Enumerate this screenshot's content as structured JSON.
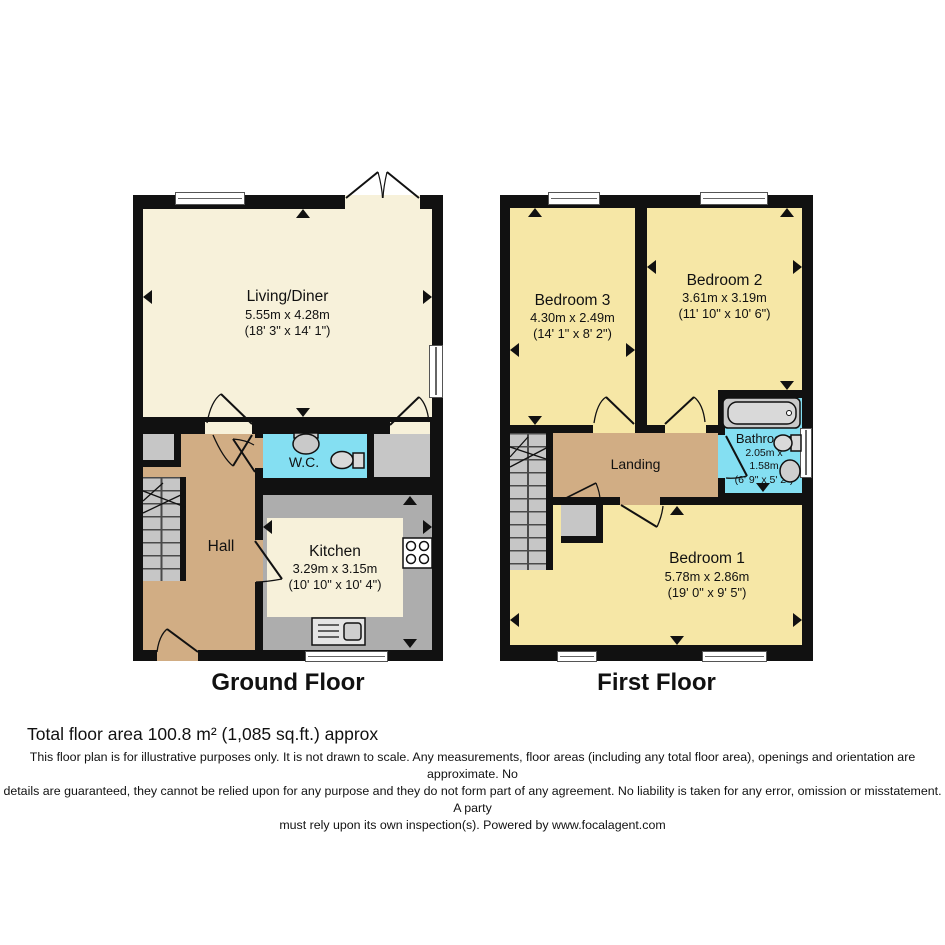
{
  "ground": {
    "caption": "Ground Floor",
    "rooms": {
      "living": {
        "name": "Living/Diner",
        "metric": "5.55m x 4.28m",
        "imperial": "(18' 3\" x 14' 1\")"
      },
      "wc": {
        "name": "W.C.",
        "fixtures": [
          "sink-icon",
          "toilet-icon"
        ]
      },
      "hall": {
        "name": "Hall",
        "fixtures": [
          "stairs-icon",
          "front-door-icon"
        ]
      },
      "kitchen": {
        "name": "Kitchen",
        "metric": "3.29m x 3.15m",
        "imperial": "(10' 10\" x 10' 4\")",
        "fixtures": [
          "hob-icon",
          "sink-icon"
        ]
      }
    }
  },
  "first": {
    "caption": "First Floor",
    "rooms": {
      "bedroom3": {
        "name": "Bedroom 3",
        "metric": "4.30m x 2.49m",
        "imperial": "(14' 1\" x 8' 2\")"
      },
      "bedroom2": {
        "name": "Bedroom 2",
        "metric": "3.61m x 3.19m",
        "imperial": "(11' 10\" x 10' 6\")"
      },
      "bedroom1": {
        "name": "Bedroom 1",
        "metric": "5.78m x 2.86m",
        "imperial": "(19' 0\" x 9' 5\")"
      },
      "bathroom": {
        "name": "Bathroom",
        "metric_line1": "2.05m x",
        "metric_line2": "1.58m",
        "imperial": "(6' 9\" x 5' 2\")",
        "fixtures": [
          "bathtub-icon",
          "toilet-icon",
          "sink-icon"
        ]
      },
      "landing": {
        "name": "Landing",
        "fixtures": [
          "stairs-icon"
        ]
      }
    }
  },
  "footer": {
    "total_area": "Total floor area 100.8 m² (1,085 sq.ft.) approx",
    "disclaimer_lines": [
      "This floor plan is for illustrative purposes only. It is not drawn to scale. Any measurements, floor areas (including any total floor area), openings and orientation are approximate. No",
      "details are guaranteed, they cannot be relied upon for any purpose and they do not form part of any agreement. No liability is taken for any error, omission or misstatement. A party",
      "must rely upon its own inspection(s). Powered by www.focalagent.com"
    ]
  },
  "colors": {
    "wall": "#111111",
    "living_kitchen_floor": "#F7F1DA",
    "bedroom_floor": "#F6E7A6",
    "hall_landing_floor": "#D1AD84",
    "wet_room_floor": "#84DFF2",
    "stairs_cupboard_gray": "#C6C6C6",
    "counter_gray": "#ADADAD"
  }
}
